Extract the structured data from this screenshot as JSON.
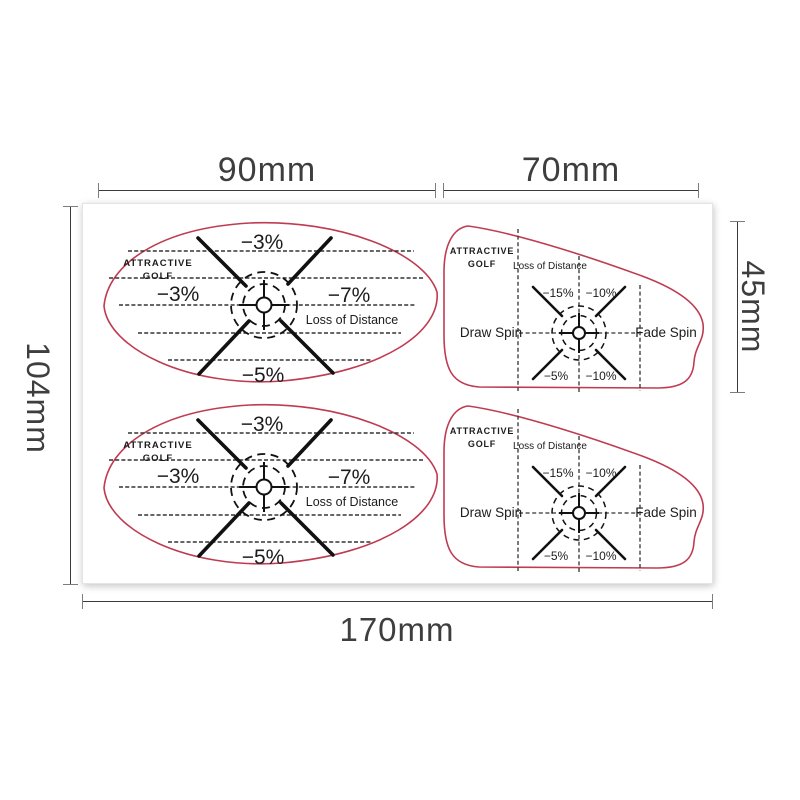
{
  "page": {
    "background": "#ffffff"
  },
  "colors": {
    "sticker_outline": "#bf3b52",
    "ink": "#1c1c1c",
    "dimension_text": "#3e3e3e",
    "dimension_line": "#3a3a3a"
  },
  "dimensions": {
    "left_width": "90mm",
    "right_width": "70mm",
    "height": "104mm",
    "iron_height": "45mm",
    "total_width": "170mm"
  },
  "driver_sticker": {
    "brand_line1": "ATTRACTIVE",
    "brand_line2": "GOLF",
    "top_pct": "−3%",
    "left_pct": "−3%",
    "right_pct": "−7%",
    "loss_label": "Loss of Distance",
    "bottom_pct": "−5%"
  },
  "iron_sticker": {
    "brand_line1": "ATTRACTIVE",
    "brand_line2": "GOLF",
    "loss_label": "Loss of Distance",
    "upper_left_pct": "−15%",
    "upper_right_pct": "−10%",
    "lower_left_pct": "−5%",
    "lower_right_pct": "−10%",
    "left_spin_label": "Draw Spin",
    "right_spin_label": "Fade Spin"
  }
}
